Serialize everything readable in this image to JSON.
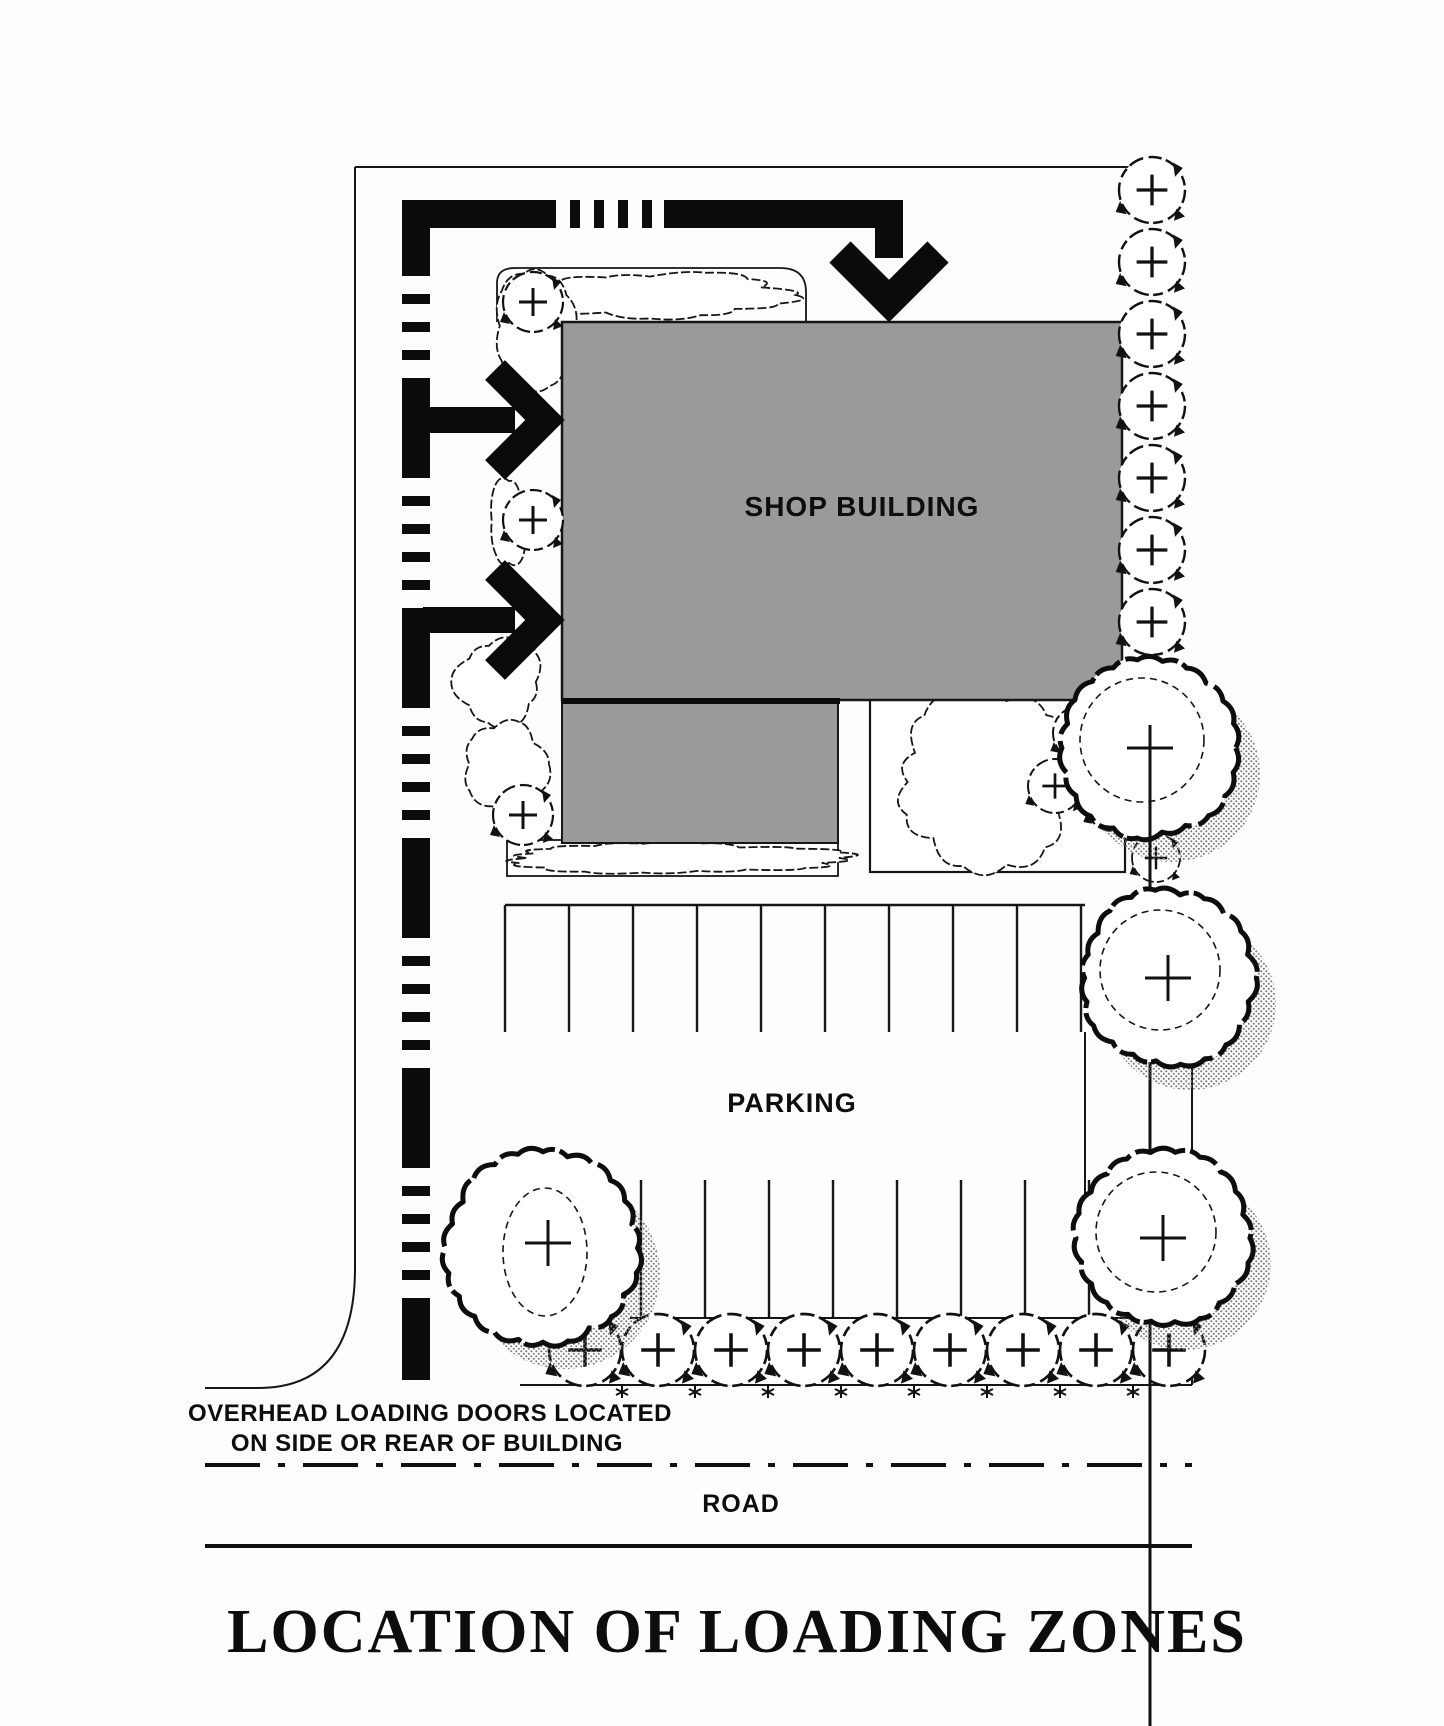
{
  "drawing": {
    "title": "LOCATION OF LOADING ZONES",
    "building_label": "SHOP BUILDING",
    "parking_label": "PARKING",
    "road_label": "ROAD",
    "note_line1": "OVERHEAD LOADING DOORS LOCATED",
    "note_line2": "ON SIDE OR REAR OF BUILDING"
  },
  "colors": {
    "building_fill": "#9a9a9a",
    "line": "#111111",
    "tree_shadow": "#7d7d7d",
    "paper": "#fdfdfd"
  },
  "icons": {
    "small_tree": "tree-circle-plus",
    "large_tree": "tree-canopy-shadow",
    "route_arrow": "loading-route-chevron-arrow",
    "ground_mark": "planting-asterisk"
  }
}
